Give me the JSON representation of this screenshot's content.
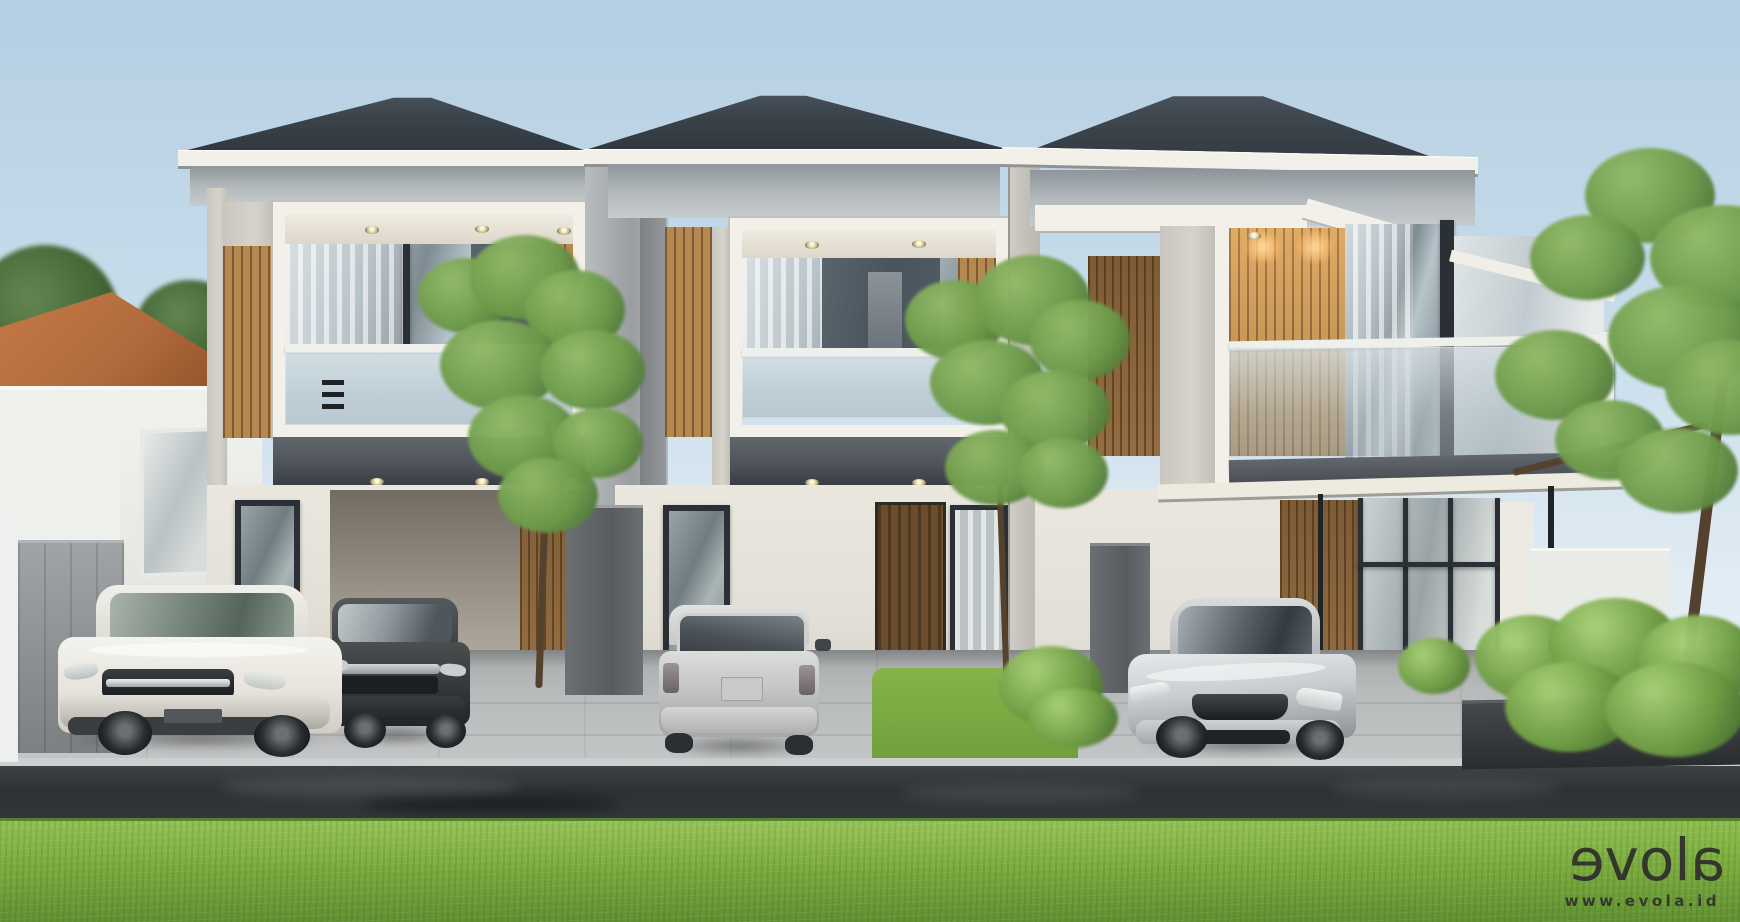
{
  "meta": {
    "kind": "architectural 3D exterior render",
    "description": "Front elevation rendering of a row of three modern two-storey tropical townhouses with dark hip roofs, timber slat cladding, glass balconies, parked cars on the driveways, a wet street and a bright green lawn in the foreground.",
    "width_px": 1740,
    "height_px": 922
  },
  "watermark": {
    "logo_text": "evola",
    "logo_letters": [
      "e",
      "v",
      "o",
      "l",
      "a"
    ],
    "mirrored_letters": [
      0,
      4
    ],
    "url": "www.evola.id"
  },
  "colors": {
    "sky-top": "#b4cee2",
    "sky-mid": "#cadeec",
    "sky-low": "#e0ebf3",
    "roof": "#3a424a",
    "roof-dark": "#2f363d",
    "fascia": "#f2f0e9",
    "concrete": "#d6d3cb",
    "wood": "#b5884f",
    "wood-dark": "#7c5a36",
    "wood-lit": "#cfa05e",
    "wall": "#eae7df",
    "wall-shade": "#d8d4ca",
    "glass-dark": "#49535b",
    "frame": "#2b3036",
    "rail": "#eef0ec",
    "slab": "#4e545a",
    "slab-dark": "#393e43",
    "fence": "#8e9294",
    "fence-dark": "#585c5f",
    "door-wood": "#6b4d2d",
    "door-wood-dark": "#4e3820",
    "pavement": "#b7babb",
    "road": "#2d3133",
    "road-light": "#5d6568",
    "lawn": "#7cab3f",
    "lawn-light": "#8cbc4c",
    "lawn-dark": "#618f31",
    "leaf": "#6d9a4a",
    "leaf-dark": "#4a7336",
    "leaf-light": "#8fb765",
    "trunk": "#55422e",
    "tile-roof": "#b06a3c",
    "tile-roof-dark": "#8f5028",
    "car-white": "#e9e8e2",
    "car-dark-grey": "#3a3d3f",
    "car-silver": "#c3c6c6",
    "watermark": "#2e2d2b"
  },
  "scene": {
    "environment": {
      "sky": "clear pale-blue morning sky",
      "foreground": "bright green mown lawn",
      "street": "dark wet asphalt with reflections",
      "driveways": "light grey concrete paving"
    },
    "buildings": [
      {
        "id": "unit-1",
        "position": "left",
        "storeys": 2,
        "features": [
          "dark charcoal hip roof",
          "white fascia band",
          "vertical timber slat cladding",
          "framed glass balcony with downlights",
          "grey inter-floor slab band",
          "ground-floor window",
          "open carport"
        ]
      },
      {
        "id": "unit-2",
        "position": "centre",
        "storeys": 2,
        "features": [
          "dark charcoal hip roof",
          "white fascia band",
          "timber slat side panels",
          "framed glass balcony with sheer curtains",
          "timber front door",
          "curtained ground-floor window"
        ]
      },
      {
        "id": "unit-3",
        "position": "right",
        "storeys": 2,
        "features": [
          "dark charcoal hip roof (angled view)",
          "wrap-around corner glass balcony",
          "warm-lit timber feature wall",
          "white entry canopy on slim steel posts",
          "glass entry wall",
          "entry steps",
          "shrub planter"
        ]
      }
    ],
    "vehicles": [
      {
        "id": "car-1",
        "type": "SUV",
        "color": "white",
        "location": "left driveway, front three-quarter view"
      },
      {
        "id": "car-2",
        "type": "SUV",
        "color": "dark grey",
        "location": "left driveway, beside the white SUV"
      },
      {
        "id": "car-3",
        "type": "hatchback",
        "color": "silver",
        "location": "centre driveway, rear view"
      },
      {
        "id": "car-4",
        "type": "sedan",
        "color": "silver",
        "location": "right driveway, front three-quarter view"
      }
    ],
    "landscaping": [
      "neighbouring house with terracotta tile roof behind the left boundary wall",
      "grey boundary fence on the left",
      "grey divider fences between driveways",
      "ornamental trees between the units",
      "tall tree and lush shrub planter on the right",
      "small lawn patch between centre and right driveways"
    ]
  }
}
